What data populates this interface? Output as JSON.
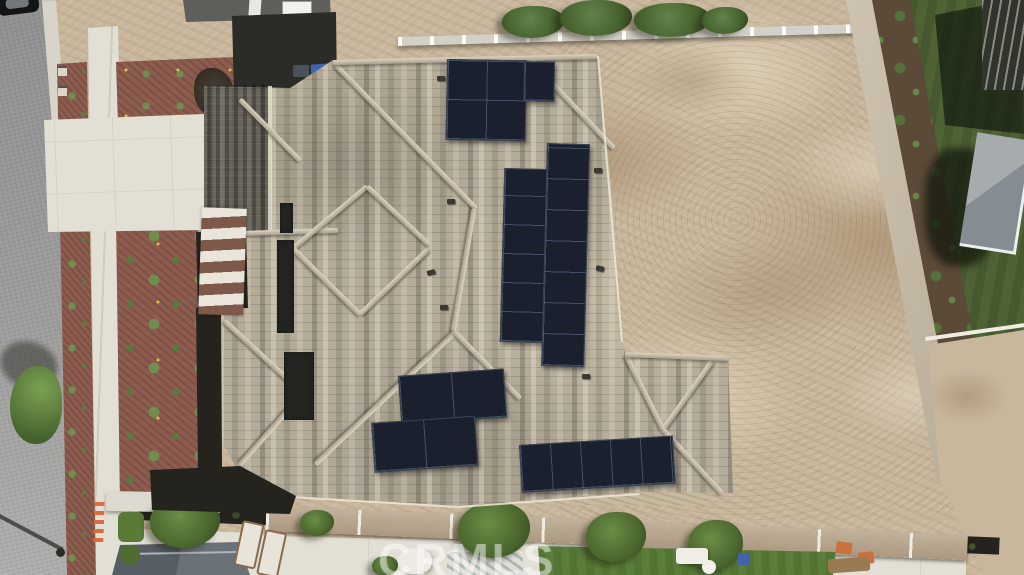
{
  "scene": {
    "type": "aerial-drone-photo",
    "description": "Straight-down aerial view of a newly built single-family home with a mottled gray-tan concrete tile roof fitted with black solar panel arrays. A gray street, concrete sidewalk, red mulch planting beds and a concrete driveway with a striped entry walk lie to the west; a large unlandscaped dirt backyard enclosed by block walls lies to the east; neighboring yards with artificial turf, a gazebo, a dark pergola, a pool with turquoise water, loungers and a shed border the top, right and bottom edges.",
    "watermark": "CRMLS"
  },
  "house": {
    "roof_material": "concrete tile, mottled gray / tan / beige",
    "solar_arrays": [
      {
        "id": "north-array",
        "panels": 5,
        "layout": "L-shape (2x2 block + 1 portrait panel)"
      },
      {
        "id": "center-array",
        "panels": 13,
        "layout": "two portrait columns of 6 and 7 panels"
      },
      {
        "id": "southwest-array",
        "panels": 4,
        "layout": "2x2 staggered rows"
      },
      {
        "id": "south-array",
        "panels": 5,
        "layout": "single row of 5 landscape panels"
      }
    ],
    "total_panels": 27
  },
  "surroundings": {
    "west": "asphalt street, light curb, mulch parkway with small shrubs, concrete sidewalk, red mulch front beds with round green shrubs, white driveway and brown/white striped entry walkway, shade tree and street light shadow",
    "north": "dirt strip, light block/vinyl fence with white post caps, row of green trees, corner of neighboring flat-roof house with skylight, blue trash bin in shadow",
    "east": "bare dirt backyard, tan perimeter block wall, neighbor artificial turf with gray gazebo and dark slatted pergola",
    "south": "tan patio awning band, hedge line, white pool deck, turquoise pool, water slide, bright turf lawn, trees, white loungers, orange chairs, gray shed and orange ladder"
  },
  "colors": {
    "street": "#8f8f8f",
    "curb": "#d8d4c9",
    "concrete": "#e2dfd5",
    "mulch": "#8d5c4e",
    "plant-green": "#6f8f50",
    "dirt": "#c9b79d",
    "dirt-light": "#ddd0b6",
    "dirt-dark": "#b29b7c",
    "roof-base": "#b4ab98",
    "ridge-light": "#ddd5c2",
    "panel-dark": "#1a202d",
    "turf-dark": "#4e6233",
    "turf-bright": "#5a7d39",
    "pool-blue": "#2fa8bd",
    "wall-tan": "#cfc5b2",
    "fence-light": "#d3d0c8",
    "shadow-dark": "#24231e",
    "shed-gray": "#565d64",
    "awning-tan": "#ab9880",
    "pergola-dark": "#2f342c",
    "bin-blue": "#3f63ad",
    "accent-orange": "#d96d3f",
    "watermark-white": "rgba(255,255,255,0.42)"
  }
}
